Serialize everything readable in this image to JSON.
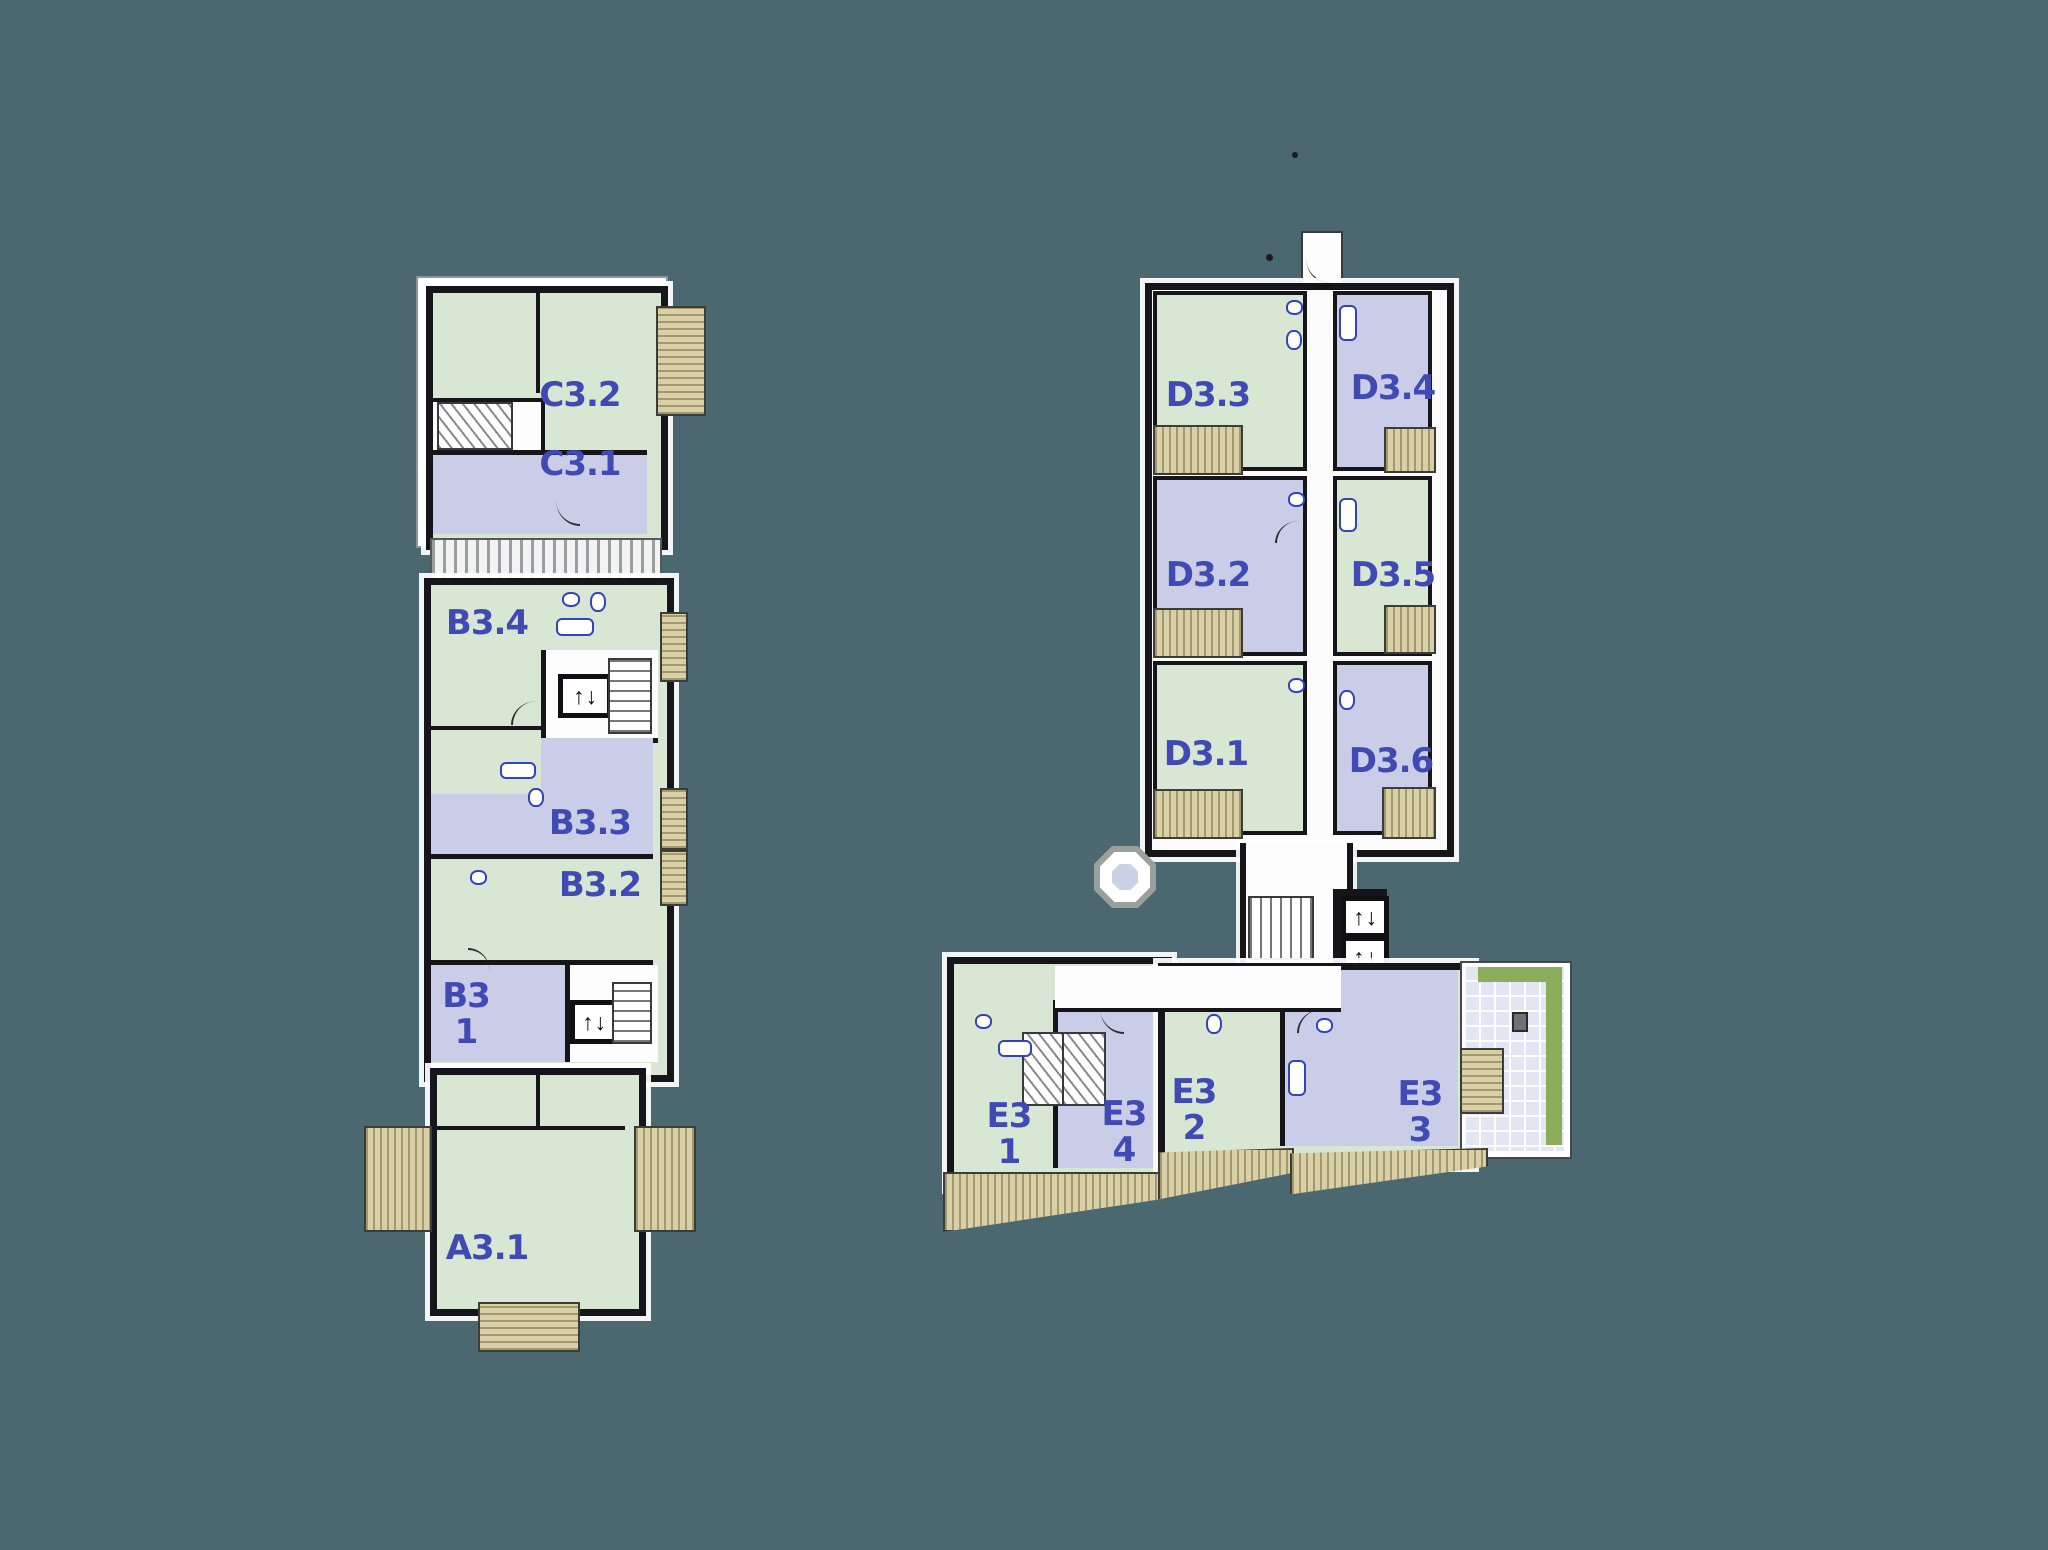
{
  "palette": {
    "background": "#4B6770",
    "unit_green": "#D7E7D4",
    "unit_lavender": "#C9CDE8",
    "wall_black": "#15151A",
    "balcony_tan": "#D9D0A7",
    "terrace_olive": "#8CAE5C",
    "label_blue": "#4149B2"
  },
  "icons": {
    "elevator_up": "↑",
    "elevator_down": "↓"
  },
  "buildings": {
    "abc": {
      "units": {
        "c32": {
          "label": "C3.2"
        },
        "c31": {
          "label": "C3.1"
        },
        "b34": {
          "label": "B3.4"
        },
        "b33": {
          "label": "B3.3"
        },
        "b32": {
          "label": "B3.2"
        },
        "b31": {
          "label": "B3",
          "sublabel": "1"
        },
        "a31": {
          "label": "A3.1"
        }
      }
    },
    "de": {
      "units": {
        "d33": {
          "label": "D3.3"
        },
        "d34": {
          "label": "D3.4"
        },
        "d32": {
          "label": "D3.2"
        },
        "d35": {
          "label": "D3.5"
        },
        "d31": {
          "label": "D3.1"
        },
        "d36": {
          "label": "D3.6"
        },
        "e31": {
          "label": "E3",
          "sublabel": "1"
        },
        "e34": {
          "label": "E3",
          "sublabel": "4"
        },
        "e32": {
          "label": "E3",
          "sublabel": "2"
        },
        "e33": {
          "label": "E3",
          "sublabel": "3"
        }
      }
    }
  }
}
